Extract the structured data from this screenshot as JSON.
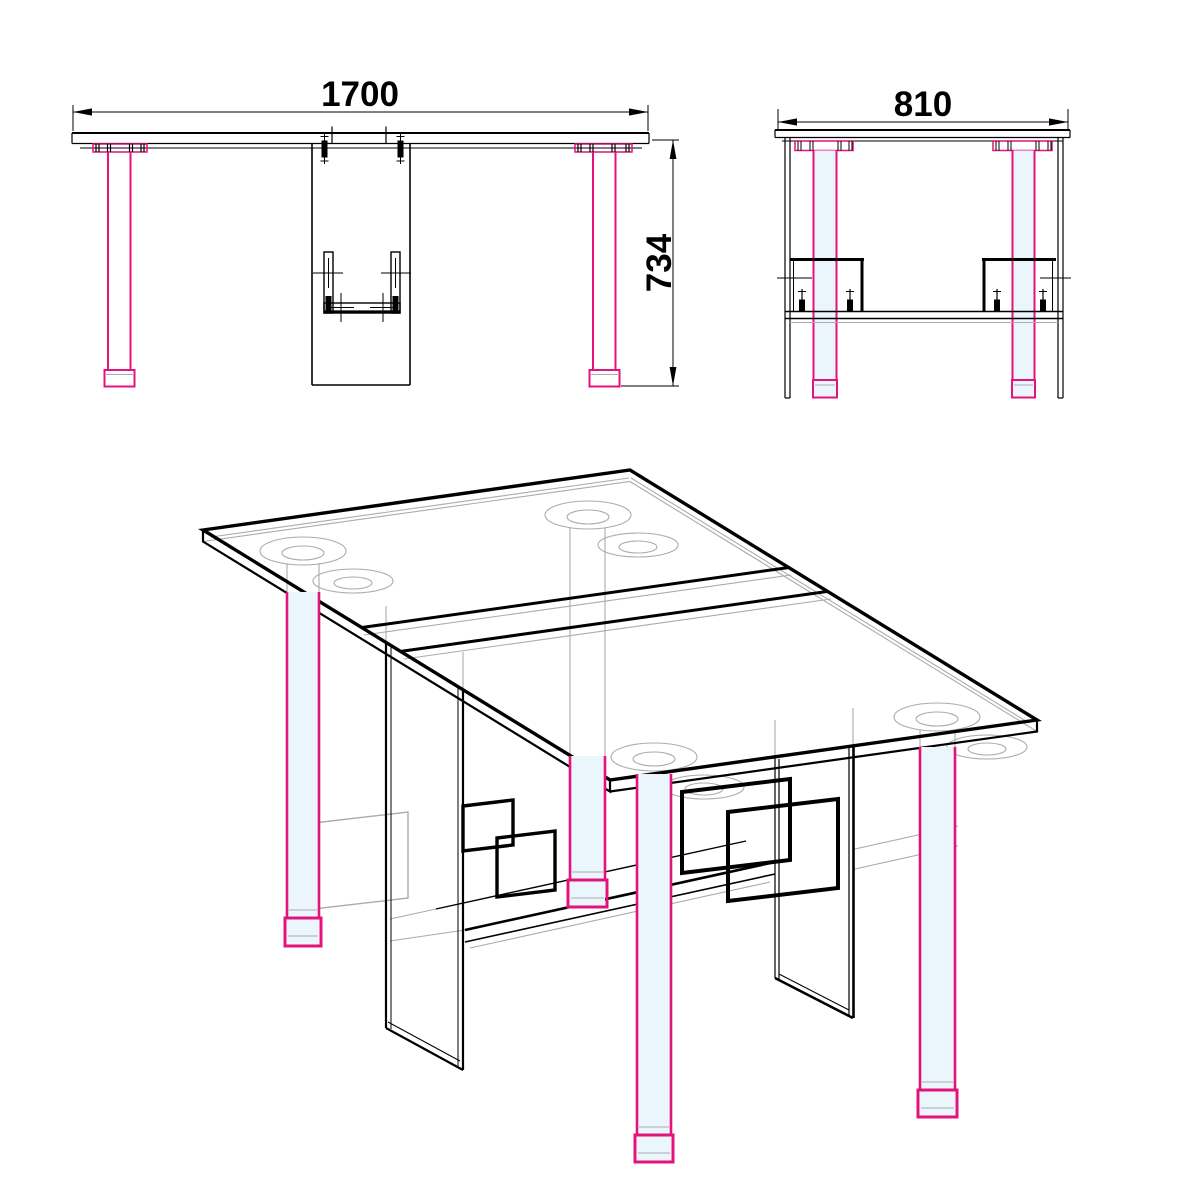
{
  "title": "Folding table technical drawing",
  "views": {
    "front": {
      "name": "front-view",
      "width_label": "1700",
      "height_label": "734"
    },
    "side": {
      "name": "side-view",
      "depth_label": "810"
    },
    "isometric": {
      "name": "isometric-view"
    }
  },
  "dimensions_mm": {
    "width": 1700,
    "depth": 810,
    "height": 734
  },
  "colors": {
    "outline": "#000000",
    "hidden_lines": "#ABABAB",
    "legs_highlight": "#E4127B",
    "leg_fill": "#EAF5FC",
    "background": "#FFFFFF"
  }
}
